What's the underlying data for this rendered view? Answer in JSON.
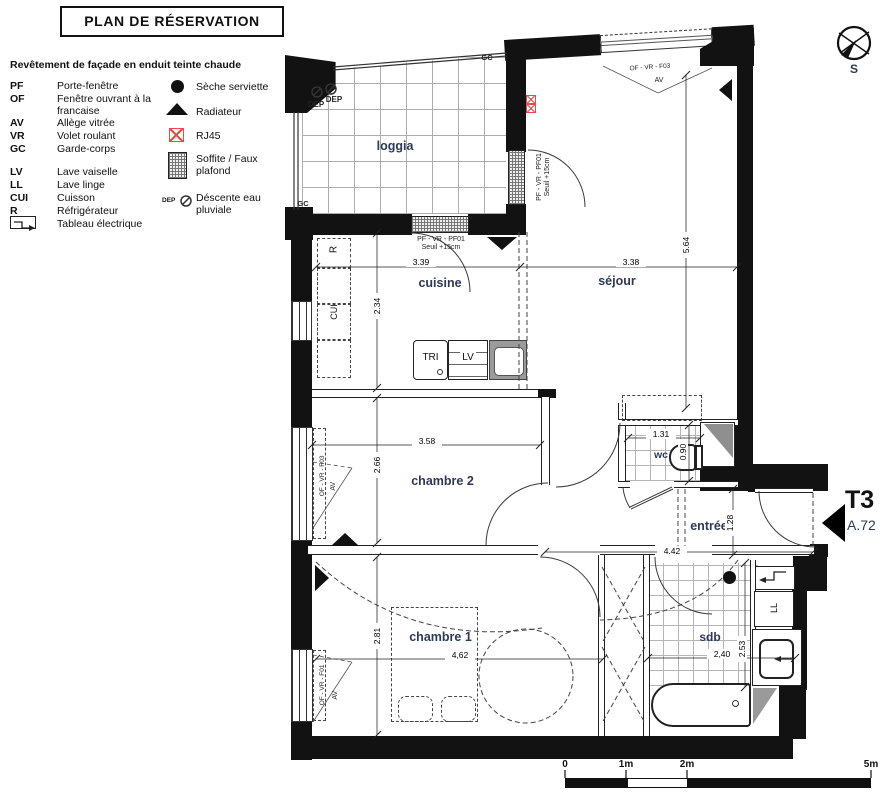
{
  "title": "PLAN DE RÉSERVATION",
  "legend": {
    "intro": "Revêtement de façade en enduit teinte chaude",
    "abbreviations": [
      {
        "abbr": "PF",
        "label": "Porte-fenêtre"
      },
      {
        "abbr": "OF",
        "label": "Fenêtre ouvrant à la francaise"
      },
      {
        "abbr": "AV",
        "label": "Allège vitrée"
      },
      {
        "abbr": "VR",
        "label": "Volet roulant"
      },
      {
        "abbr": "GC",
        "label": "Garde-corps"
      },
      {
        "abbr": "LV",
        "label": "Lave vaiselle"
      },
      {
        "abbr": "LL",
        "label": "Lave linge"
      },
      {
        "abbr": "CUI",
        "label": "Cuisson"
      },
      {
        "abbr": "R",
        "label": "Réfrigérateur"
      },
      {
        "abbr": "",
        "label": "Tableau électrique"
      }
    ],
    "symbols": [
      {
        "name": "seche-serviette",
        "label": "Sèche serviette"
      },
      {
        "name": "radiateur",
        "label": "Radiateur"
      },
      {
        "name": "rj45",
        "label": "RJ45"
      },
      {
        "name": "soffite-faux-plafond",
        "label": "Soffite / Faux plafond"
      },
      {
        "name": "descente-eau-pluviale",
        "label": "Déscente eau pluviale"
      }
    ]
  },
  "rooms": {
    "loggia": "loggia",
    "cuisine": "cuisine",
    "sejour": "séjour",
    "chambre2": "chambre 2",
    "chambre1": "chambre 1",
    "wc": "wc",
    "entree": "entrée",
    "sdb": "sdb"
  },
  "dims": {
    "cuisine_w": "3.39",
    "cuisine_h": "2.34",
    "sejour_w": "3.38",
    "sejour_h": "5.64",
    "chambre2_w": "3.58",
    "chambre2_h": "2.66",
    "wc_w": "1.31",
    "wc_h": "0.90",
    "entree_w": "4.42",
    "entree_h": "1.28",
    "chambre1_w": "4,62",
    "chambre1_h": "2.81",
    "sdb_w": "2,40",
    "sdb_h": "2.53"
  },
  "openings": {
    "pf_vr_pf01": "PF - VR - PF01",
    "seuil": "Seuil +15cm",
    "of_vr_f03": "OF - VR - F03",
    "of_vr_f01": "OF - VR - F01",
    "av": "AV",
    "gc": "GC",
    "dep": "DEP"
  },
  "fixtures": {
    "tri": "TRI",
    "lv": "LV",
    "refrigerateur": "R",
    "cuisson": "CUI",
    "lave_linge": "LL"
  },
  "unit": {
    "type": "T3",
    "lot": "A.72"
  },
  "compass": {
    "south": "S"
  },
  "scale_bar": {
    "t0": "0",
    "t1": "1m",
    "t2": "2m",
    "t5": "5m"
  },
  "colors": {
    "accent_red": "#e84b4b",
    "label_blue": "#2e3a55",
    "wall_black": "#121212"
  }
}
